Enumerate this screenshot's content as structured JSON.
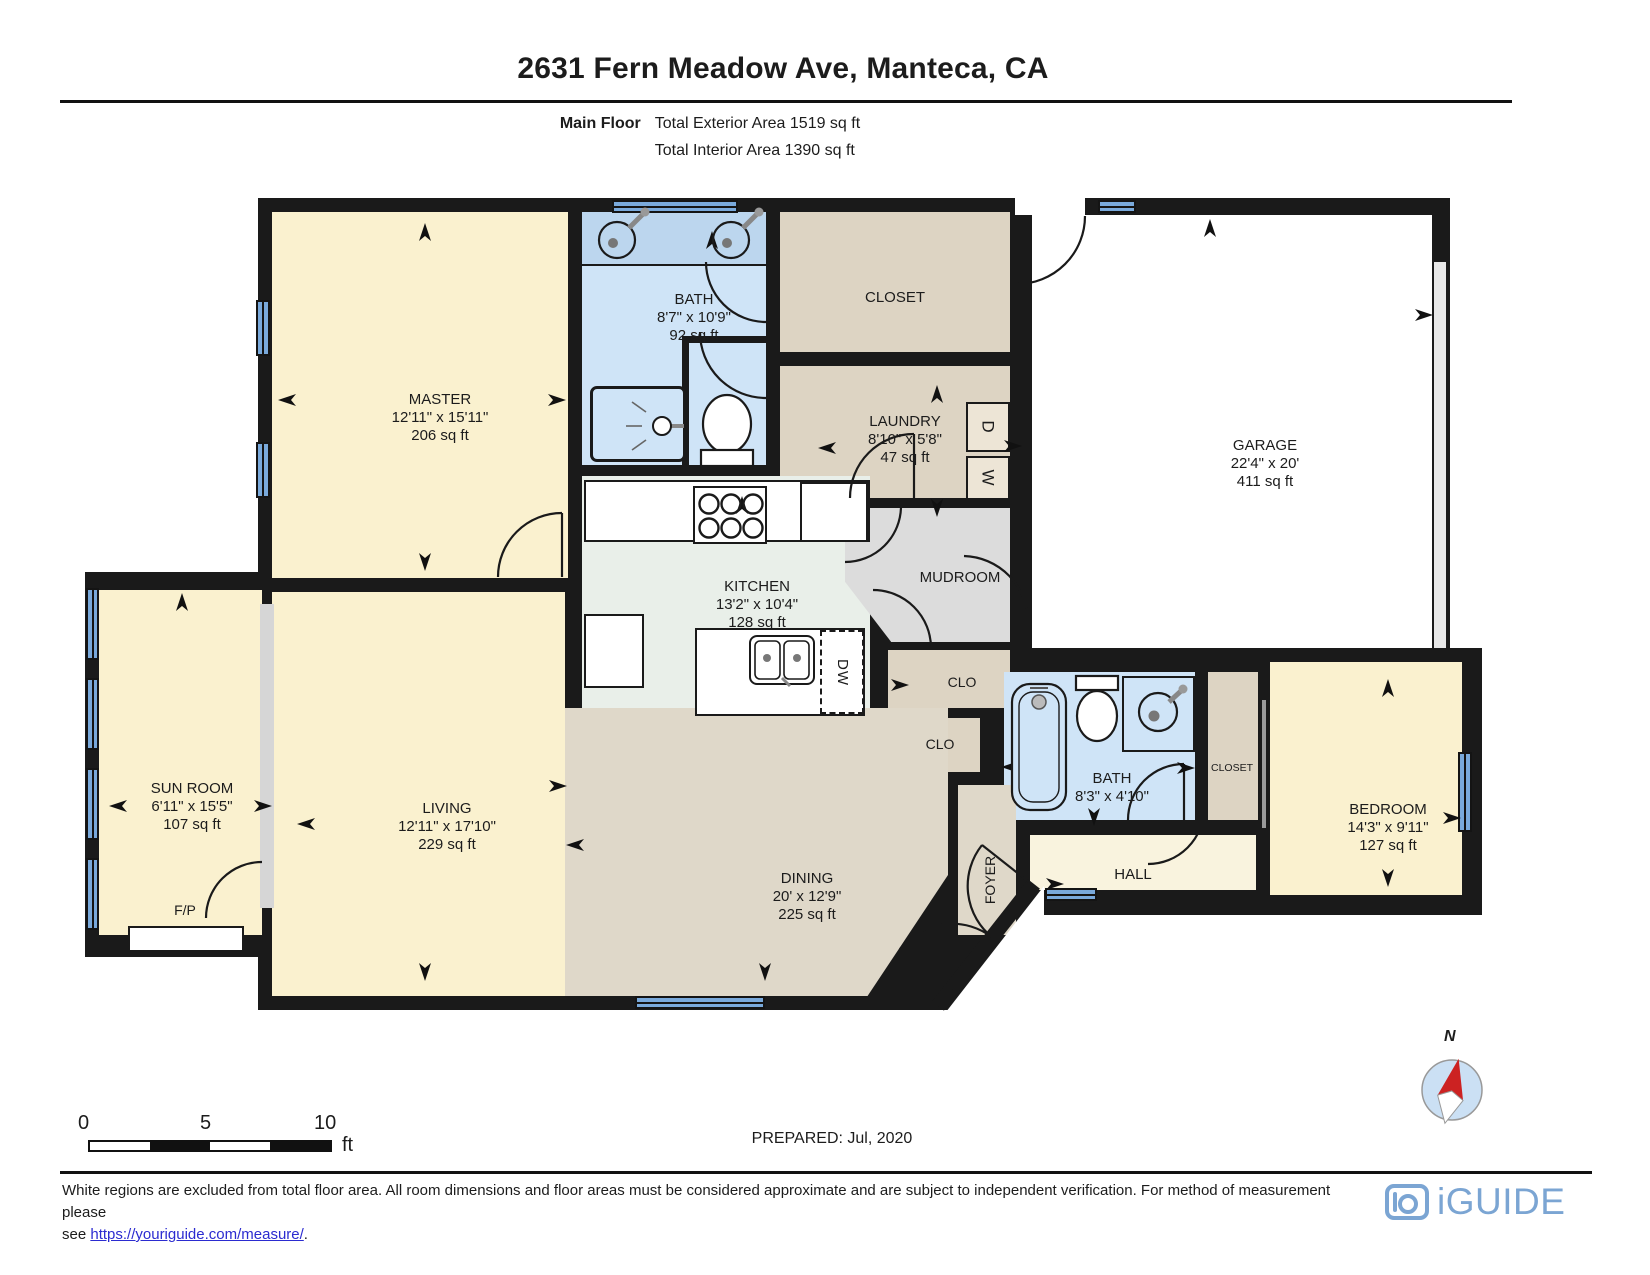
{
  "palette": {
    "wall": "#1a1a1a",
    "beige": "#FAF1CF",
    "tan": "#DDD4C3",
    "tan2": "#DFD8C9",
    "blue": "#CFE4F7",
    "blue_dark": "#BCD6EE",
    "kitchen": "#E9EFE9",
    "grey": "#DCDCDC",
    "hall": "#F9F3DE",
    "window": "#79A9DB",
    "brand": "#7BA5D3",
    "link": "#2B2BD0",
    "compass_fill": "#CBE0F4",
    "needle_red": "#CC2222"
  },
  "header": {
    "title": "2631 Fern Meadow Ave, Manteca, CA",
    "floor_label": "Main Floor",
    "exterior": "Total Exterior Area 1519 sq ft",
    "interior": "Total Interior Area 1390 sq ft"
  },
  "rooms": {
    "master": {
      "name": "MASTER",
      "dims": "12'11\" x 15'11\"",
      "area": "206 sq ft"
    },
    "bath1": {
      "name": "BATH",
      "dims": "8'7\" x 10'9\"",
      "area": "92 sq ft"
    },
    "closet_top": {
      "name": "CLOSET"
    },
    "laundry": {
      "name": "LAUNDRY",
      "dims": "8'10\" x 5'8\"",
      "area": "47 sq ft"
    },
    "garage": {
      "name": "GARAGE",
      "dims": "22'4\" x 20'",
      "area": "411 sq ft"
    },
    "kitchen": {
      "name": "KITCHEN",
      "dims": "13'2\" x 10'4\"",
      "area": "128 sq ft"
    },
    "mudroom": {
      "name": "MUDROOM"
    },
    "clo1": {
      "name": "CLO"
    },
    "clo2": {
      "name": "CLO"
    },
    "bath2": {
      "name": "BATH",
      "dims": "8'3\" x 4'10\""
    },
    "closet_hall": {
      "name": "CLOSET"
    },
    "bedroom": {
      "name": "BEDROOM",
      "dims": "14'3\" x 9'11\"",
      "area": "127 sq ft"
    },
    "hall": {
      "name": "HALL"
    },
    "foyer": {
      "name": "FOYER"
    },
    "sunroom": {
      "name": "SUN ROOM",
      "dims": "6'11\" x 15'5\"",
      "area": "107 sq ft"
    },
    "living": {
      "name": "LIVING",
      "dims": "12'11\" x 17'10\"",
      "area": "229 sq ft"
    },
    "dining": {
      "name": "DINING",
      "dims": "20' x 12'9\"",
      "area": "225 sq ft"
    },
    "fireplace": {
      "name": "F/P"
    }
  },
  "appliances": {
    "dryer": "D",
    "washer": "W",
    "dishwasher": "DW"
  },
  "scale_bar": {
    "ticks": [
      "0",
      "5",
      "10"
    ],
    "unit": "ft"
  },
  "prepared": "PREPARED: Jul, 2020",
  "compass": {
    "label": "N"
  },
  "footer": {
    "line1": "White regions are excluded from total floor area. All room dimensions and floor areas must be considered approximate and are subject to independent verification. For method of measurement please",
    "line2_prefix": "see ",
    "link": "https://youriguide.com/measure/",
    "line2_suffix": "."
  },
  "brand": {
    "logo": "iGUIDE"
  }
}
